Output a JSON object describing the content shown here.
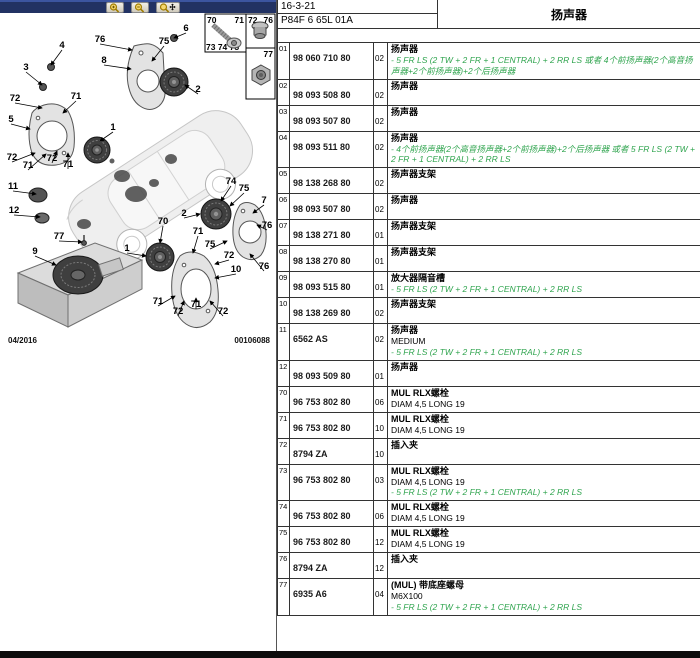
{
  "header": {
    "doc_code": "16-3-21",
    "page_code": "P84F 6 65L 01A",
    "title": "扬声器"
  },
  "toolbar": {
    "buttons": [
      {
        "icon": "zoom-in-icon"
      },
      {
        "icon": "zoom-out-icon"
      },
      {
        "icon": "zoom-pan-icon"
      }
    ]
  },
  "footer": {
    "date": "04/2016",
    "drawing_number": "00106088"
  },
  "colors": {
    "note_green": "#2FA44E",
    "toolbar_navy": "#223263"
  },
  "legend": {
    "box1": {
      "top_left": "70",
      "top_right": "71",
      "bottom": "73 74 75"
    },
    "box2": {
      "left": "72",
      "right": "76"
    },
    "box3": {
      "label": "77"
    }
  },
  "diagram": {
    "callouts": [
      {
        "n": "6",
        "x": 186,
        "y": 18,
        "tx": 174,
        "ty": 25
      },
      {
        "n": "76",
        "x": 100,
        "y": 29,
        "tx": 132,
        "ty": 37
      },
      {
        "n": "75",
        "x": 164,
        "y": 31,
        "tx": 152,
        "ty": 48
      },
      {
        "n": "8",
        "x": 104,
        "y": 50,
        "tx": 131,
        "ty": 56
      },
      {
        "n": "4",
        "x": 62,
        "y": 35,
        "tx": 51,
        "ty": 52
      },
      {
        "n": "3",
        "x": 26,
        "y": 57,
        "tx": 42,
        "ty": 72
      },
      {
        "n": "2",
        "x": 198,
        "y": 79,
        "tx": 185,
        "ty": 72
      },
      {
        "n": "72",
        "x": 15,
        "y": 88,
        "tx": 42,
        "ty": 95
      },
      {
        "n": "71",
        "x": 76,
        "y": 86,
        "tx": 63,
        "ty": 100
      },
      {
        "n": "5",
        "x": 11,
        "y": 109,
        "tx": 30,
        "ty": 116
      },
      {
        "n": "1",
        "x": 113,
        "y": 117,
        "tx": 100,
        "ty": 128
      },
      {
        "n": "72",
        "x": 12,
        "y": 147,
        "tx": 35,
        "ty": 140
      },
      {
        "n": "71",
        "x": 28,
        "y": 155,
        "tx": 46,
        "ty": 141
      },
      {
        "n": "72",
        "x": 52,
        "y": 148,
        "tx": 57,
        "ty": 138
      },
      {
        "n": "71",
        "x": 68,
        "y": 154,
        "tx": 68,
        "ty": 140
      },
      {
        "n": "11",
        "x": 13,
        "y": 176,
        "tx": 36,
        "ty": 181
      },
      {
        "n": "12",
        "x": 14,
        "y": 200,
        "tx": 40,
        "ty": 204
      },
      {
        "n": "9",
        "x": 35,
        "y": 241,
        "tx": 56,
        "ty": 252
      },
      {
        "n": "77",
        "x": 59,
        "y": 226,
        "tx": 82,
        "ty": 229
      },
      {
        "n": "70",
        "x": 163,
        "y": 211,
        "tx": 160,
        "ty": 230
      },
      {
        "n": "1",
        "x": 127,
        "y": 238,
        "tx": 146,
        "ty": 243
      },
      {
        "n": "2",
        "x": 184,
        "y": 203,
        "tx": 200,
        "ty": 201
      },
      {
        "n": "74",
        "x": 231,
        "y": 171,
        "tx": 221,
        "ty": 188
      },
      {
        "n": "75",
        "x": 244,
        "y": 178,
        "tx": 230,
        "ty": 193
      },
      {
        "n": "7",
        "x": 264,
        "y": 190,
        "tx": 253,
        "ty": 200
      },
      {
        "n": "76",
        "x": 267,
        "y": 215,
        "tx": 257,
        "ty": 212
      },
      {
        "n": "71",
        "x": 198,
        "y": 221,
        "tx": 193,
        "ty": 240
      },
      {
        "n": "75",
        "x": 210,
        "y": 234,
        "tx": 227,
        "ty": 228
      },
      {
        "n": "72",
        "x": 229,
        "y": 245,
        "tx": 215,
        "ty": 251
      },
      {
        "n": "10",
        "x": 236,
        "y": 259,
        "tx": 215,
        "ty": 265
      },
      {
        "n": "76",
        "x": 264,
        "y": 256,
        "tx": 250,
        "ty": 241
      },
      {
        "n": "71",
        "x": 158,
        "y": 291,
        "tx": 175,
        "ty": 283
      },
      {
        "n": "72",
        "x": 178,
        "y": 301,
        "tx": 184,
        "ty": 288
      },
      {
        "n": "71",
        "x": 196,
        "y": 294,
        "tx": 196,
        "ty": 285
      },
      {
        "n": "72",
        "x": 223,
        "y": 301,
        "tx": 210,
        "ty": 288
      }
    ]
  },
  "table": {
    "rows": [
      {
        "idx": "01",
        "part": "98 060 710 80",
        "qty": "02",
        "name": "扬声器",
        "extra": [],
        "notes": [
          "- 5 FR LS (2 TW + 2 FR + 1 CENTRAL) + 2 RR LS 或者 4个前扬声器(2个高音扬声器+2个前扬声器)+2个后扬声器"
        ]
      },
      {
        "idx": "02",
        "part": "98 093 508 80",
        "qty": "02",
        "name": "扬声器",
        "extra": [],
        "notes": []
      },
      {
        "idx": "03",
        "part": "98 093 507 80",
        "qty": "02",
        "name": "扬声器",
        "extra": [],
        "notes": []
      },
      {
        "idx": "04",
        "part": "98 093 511 80",
        "qty": "02",
        "name": "扬声器",
        "extra": [],
        "notes": [
          "- 4个前扬声器(2个高音扬声器+2个前扬声器)+2个后扬声器 或者 5 FR LS (2 TW + 2 FR + 1 CENTRAL) + 2 RR LS"
        ]
      },
      {
        "idx": "05",
        "part": "98 138 268 80",
        "qty": "02",
        "name": "扬声器支架",
        "extra": [],
        "notes": []
      },
      {
        "idx": "06",
        "part": "98 093 507 80",
        "qty": "02",
        "name": "扬声器",
        "extra": [],
        "notes": []
      },
      {
        "idx": "07",
        "part": "98 138 271 80",
        "qty": "01",
        "name": "扬声器支架",
        "extra": [],
        "notes": []
      },
      {
        "idx": "08",
        "part": "98 138 270 80",
        "qty": "01",
        "name": "扬声器支架",
        "extra": [],
        "notes": []
      },
      {
        "idx": "09",
        "part": "98 093 515 80",
        "qty": "01",
        "name": "放大器隔音槽",
        "extra": [],
        "notes": [
          "- 5 FR LS (2 TW + 2 FR + 1 CENTRAL) + 2 RR LS"
        ]
      },
      {
        "idx": "10",
        "part": "98 138 269 80",
        "qty": "02",
        "name": "扬声器支架",
        "extra": [],
        "notes": []
      },
      {
        "idx": "11",
        "part": "6562 AS",
        "qty": "02",
        "name": "扬声器",
        "extra": [
          "MEDIUM"
        ],
        "notes": [
          "- 5 FR LS (2 TW + 2 FR + 1 CENTRAL) + 2 RR LS"
        ]
      },
      {
        "idx": "12",
        "part": "98 093 509 80",
        "qty": "01",
        "name": "扬声器",
        "extra": [],
        "notes": []
      },
      {
        "idx": "70",
        "part": "96 753 802 80",
        "qty": "06",
        "name": "MUL RLX螺栓",
        "extra": [
          "DIAM 4,5 LONG 19"
        ],
        "notes": []
      },
      {
        "idx": "71",
        "part": "96 753 802 80",
        "qty": "10",
        "name": "MUL RLX螺栓",
        "extra": [
          "DIAM 4,5 LONG 19"
        ],
        "notes": []
      },
      {
        "idx": "72",
        "part": "8794 ZA",
        "qty": "10",
        "name": "插入夹",
        "extra": [],
        "notes": []
      },
      {
        "idx": "73",
        "part": "96 753 802 80",
        "qty": "03",
        "name": "MUL RLX螺栓",
        "extra": [
          "DIAM 4,5 LONG 19"
        ],
        "notes": [
          "- 5 FR LS (2 TW + 2 FR + 1 CENTRAL) + 2 RR LS"
        ]
      },
      {
        "idx": "74",
        "part": "96 753 802 80",
        "qty": "06",
        "name": "MUL RLX螺栓",
        "extra": [
          "DIAM 4,5 LONG 19"
        ],
        "notes": []
      },
      {
        "idx": "75",
        "part": "96 753 802 80",
        "qty": "12",
        "name": "MUL RLX螺栓",
        "extra": [
          "DIAM 4,5 LONG 19"
        ],
        "notes": []
      },
      {
        "idx": "76",
        "part": "8794 ZA",
        "qty": "12",
        "name": "插入夹",
        "extra": [],
        "notes": []
      },
      {
        "idx": "77",
        "part": "6935 A6",
        "qty": "04",
        "name": "(MUL) 带底座螺母",
        "extra": [
          "M6X100"
        ],
        "notes": [
          "- 5 FR LS (2 TW + 2 FR + 1 CENTRAL) + 2 RR LS"
        ]
      }
    ]
  }
}
